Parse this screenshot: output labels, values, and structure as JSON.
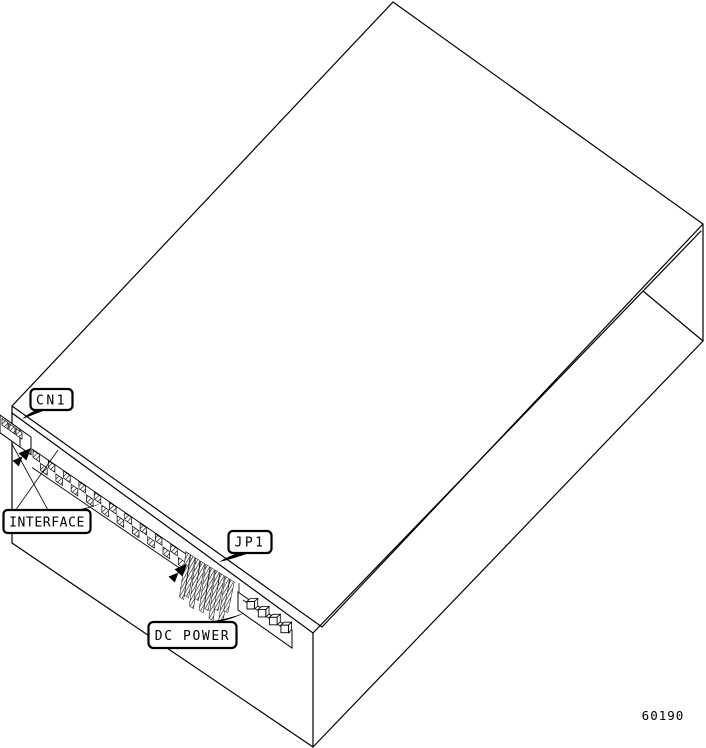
{
  "diagram": {
    "type": "technical-line-illustration",
    "subject": "disk drive shown in isometric view with rear connector callouts",
    "callouts": [
      {
        "id": "cn1",
        "label": "CN1"
      },
      {
        "id": "interface",
        "label": "INTERFACE"
      },
      {
        "id": "jp1",
        "label": "JP1"
      },
      {
        "id": "dc-power",
        "label": "DC POWER"
      }
    ],
    "part_number": "60190",
    "colors": {
      "line": "#000000",
      "background": "#ffffff"
    }
  }
}
